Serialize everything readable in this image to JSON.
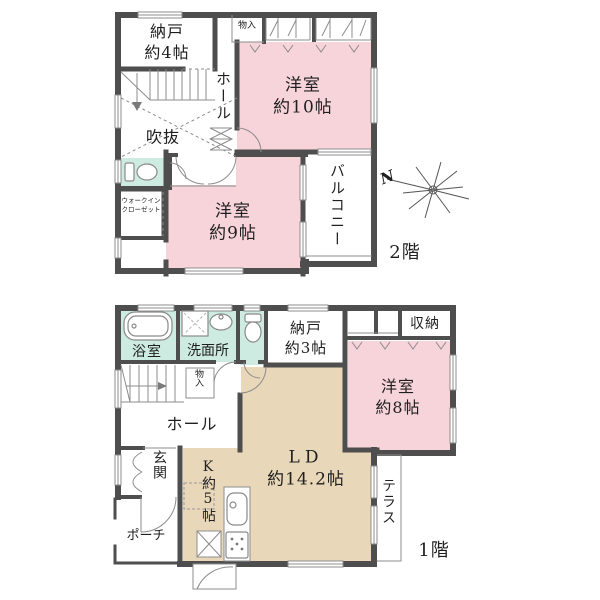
{
  "colors": {
    "wall": "#4e4e4e",
    "line": "#8c8c8c",
    "text": "#1f1f1f",
    "room_pink": "#f7d4da",
    "room_green": "#cdebe0",
    "room_tan": "#e8d7b8"
  },
  "floor2": {
    "floor_label": "2階",
    "compass_n": "N",
    "nando": {
      "line1": "納戸",
      "line2": "約4帖"
    },
    "monoire": "物入",
    "room10": {
      "line1": "洋室",
      "line2": "約10帖"
    },
    "hall": "ホール",
    "fukinuke": "吹抜",
    "room9": {
      "line1": "洋室",
      "line2": "約9帖"
    },
    "balcony": "バルコニー",
    "wic": {
      "line1": "ウォークイン",
      "line2": "クローゼット"
    }
  },
  "floor1": {
    "floor_label": "1階",
    "bath": "浴室",
    "washroom": "洗面所",
    "nando": {
      "line1": "納戸",
      "line2": "約3帖"
    },
    "shuno": "収納",
    "room8": {
      "line1": "洋室",
      "line2": "約8帖"
    },
    "hall": "ホール",
    "monoire": "物入",
    "genkan": "玄関",
    "porch": "ポーチ",
    "kitchen": "K約5帖",
    "ld": {
      "line1": "LD",
      "line2": "約14.2帖"
    },
    "terrace": "テラス"
  }
}
